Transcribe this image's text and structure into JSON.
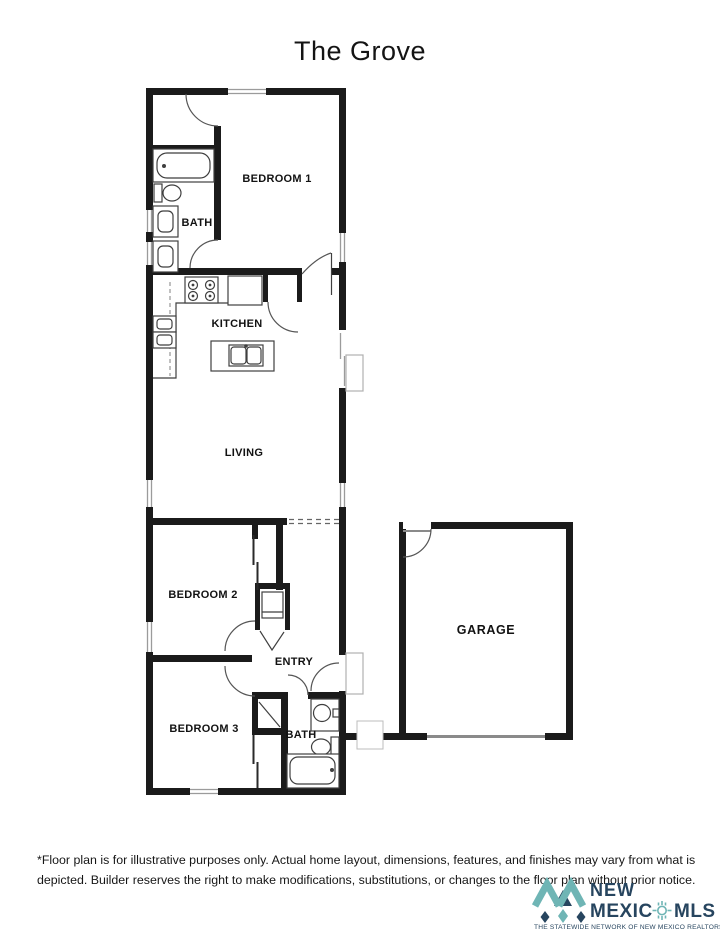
{
  "title": "The Grove",
  "plan": {
    "rooms": {
      "bedroom1": "BEDROOM 1",
      "bath1": "BATH",
      "kitchen": "KITCHEN",
      "living": "LIVING",
      "bedroom2": "BEDROOM 2",
      "entry": "ENTRY",
      "bedroom3": "BEDROOM 3",
      "bath2": "BATH",
      "garage": "GARAGE"
    }
  },
  "disclaimer": {
    "line1": "*Floor plan is for illustrative purposes only. Actual home layout, dimensions, features, and finishes may vary from what is",
    "line2": "depicted. Builder reserves the right to make modifications, substitutions, or changes to the floor plan without prior notice."
  },
  "logo": {
    "word1": "NEW",
    "word2": "MEXIC",
    "word3": "MLS",
    "tagline": "THE STATEWIDE NETWORK OF NEW MEXICO REALTORS®",
    "teal": "#6fb5b5",
    "navy": "#27455f"
  },
  "colors": {
    "wall": "#1b1b1b",
    "fixture_line": "#3f3f3f",
    "window_line": "#9b9b9b",
    "background": "#ffffff"
  }
}
